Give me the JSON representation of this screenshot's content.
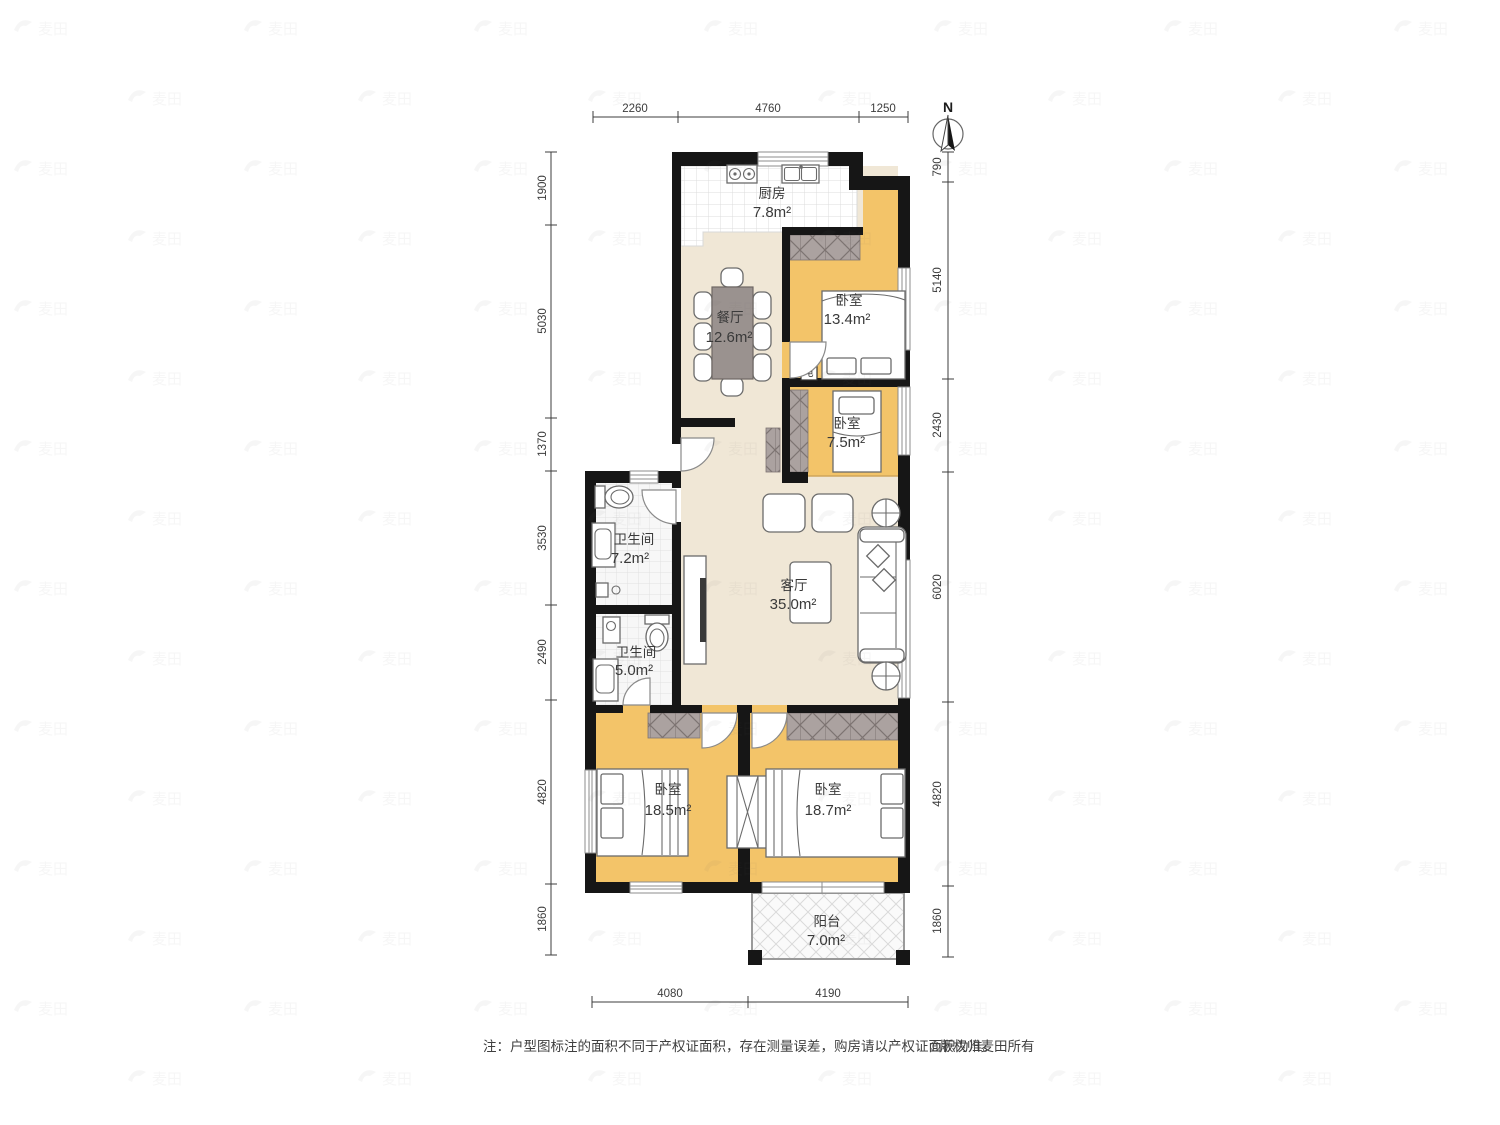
{
  "compass": {
    "north_label": "N"
  },
  "rooms": {
    "kitchen": {
      "name": "厨房",
      "area": "7.8m²"
    },
    "dining": {
      "name": "餐厅",
      "area": "12.6m²"
    },
    "bedroom_top": {
      "name": "卧室",
      "area": "13.4m²"
    },
    "bedroom_small": {
      "name": "卧室",
      "area": "7.5m²"
    },
    "bath_large": {
      "name": "卫生间",
      "area": "7.2m²"
    },
    "living": {
      "name": "客厅",
      "area": "35.0m²"
    },
    "bath_small": {
      "name": "卫生间",
      "area": "5.0m²"
    },
    "bedroom_left": {
      "name": "卧室",
      "area": "18.5m²"
    },
    "bedroom_right": {
      "name": "卧室",
      "area": "18.7m²"
    },
    "balcony": {
      "name": "阳台",
      "area": "7.0m²"
    }
  },
  "dimensions": {
    "top": [
      "2260",
      "4760",
      "1250"
    ],
    "left": [
      "1900",
      "5030",
      "1370",
      "3530",
      "2490",
      "4820",
      "1860"
    ],
    "right": [
      "790",
      "5140",
      "2430",
      "6020",
      "4820",
      "1860"
    ],
    "bottom": [
      "4080",
      "4190"
    ]
  },
  "annotations": {
    "electric_box": "电"
  },
  "watermark": {
    "text": "麦田"
  },
  "footer": {
    "note": "注：户型图标注的面积不同于产权证面积，存在测量误差，购房请以产权证面积为准。",
    "copyright": "©版权归麦田所有"
  },
  "colors": {
    "bedroom_floor": "#F3C469",
    "public_floor": "#F0E7D6",
    "wall": "#161616",
    "wardrobe": "#ABA2A0"
  }
}
